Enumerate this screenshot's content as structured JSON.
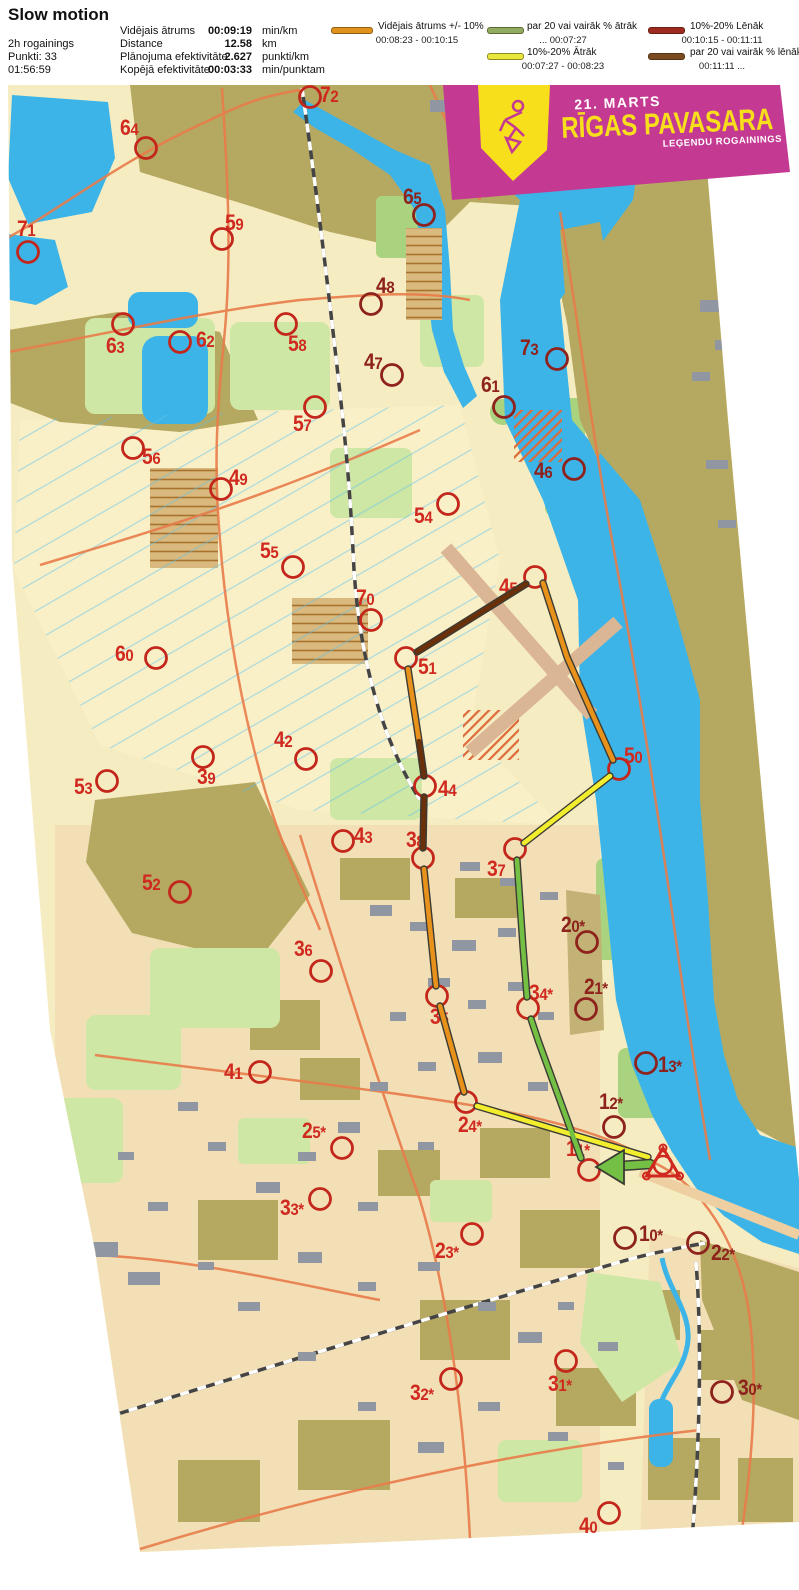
{
  "header": {
    "title": "Slow motion",
    "left": [
      "2h rogainings",
      "Punkti: 33",
      "01:56:59"
    ],
    "stats": [
      {
        "label": "Vidējais ātrums",
        "value": "00:09:19",
        "unit": "min/km"
      },
      {
        "label": "Distance",
        "value": "12.58",
        "unit": "km"
      },
      {
        "label": "Plānojuma efektivitāte",
        "value": "2.627",
        "unit": "punkti/km"
      },
      {
        "label": "Kopējā efektivitāte",
        "value": "00:03:33",
        "unit": "min/punktam"
      }
    ]
  },
  "legend": {
    "items": [
      {
        "name": "average-pace",
        "color": "#e0921f",
        "label": "Vidējais ātrums +/- 10%",
        "range": "00:08:23  -  00:10:15"
      },
      {
        "name": "faster-20",
        "color": "#8fac60",
        "label": "par 20 vai vairāk % ātrāk",
        "range": "...  00:07:27"
      },
      {
        "name": "faster-10-20",
        "color": "#e8e83c",
        "label": "10%-20% Ātrāk",
        "range": "00:07:27  -  00:08:23"
      },
      {
        "name": "slower-10-20",
        "color": "#9e2a20",
        "label": "10%-20% Lēnāk",
        "range": "00:10:15  -  00:11:11"
      },
      {
        "name": "slower-20",
        "color": "#7a4a20",
        "label": "par 20 vai vairāk % lēnāk",
        "range": "00:11:11  ..."
      }
    ]
  },
  "banner": {
    "date": "21. MARTS",
    "title": "RĪGAS PAVASARA",
    "subtitle": "LEĢENDU ROGAININGS",
    "bg": "#c43a93",
    "accent": "#f8df1b"
  },
  "map": {
    "label_color": "#d02a20",
    "label_color_dark": "#8e221c",
    "circle_color": "#c3271b",
    "circle_color_dark": "#8e221c",
    "start": {
      "x": 663,
      "y": 1165
    },
    "controls": [
      {
        "id": "72",
        "x": 310,
        "y": 97,
        "lx": 320,
        "ly": 84
      },
      {
        "id": "64",
        "x": 146,
        "y": 148,
        "lx": 120,
        "ly": 117
      },
      {
        "id": "65",
        "x": 424,
        "y": 215,
        "lx": 403,
        "ly": 186,
        "dark": true
      },
      {
        "id": "71",
        "x": 28,
        "y": 252,
        "lx": 17,
        "ly": 218
      },
      {
        "id": "59",
        "x": 222,
        "y": 239,
        "lx": 225,
        "ly": 212
      },
      {
        "id": "48",
        "x": 371,
        "y": 304,
        "lx": 376,
        "ly": 275,
        "dark": true
      },
      {
        "id": "63",
        "x": 123,
        "y": 324,
        "lx": 106,
        "ly": 335
      },
      {
        "id": "62",
        "x": 180,
        "y": 342,
        "lx": 196,
        "ly": 329
      },
      {
        "id": "58",
        "x": 286,
        "y": 324,
        "lx": 288,
        "ly": 333
      },
      {
        "id": "47",
        "x": 392,
        "y": 375,
        "lx": 364,
        "ly": 351,
        "dark": true
      },
      {
        "id": "57",
        "x": 315,
        "y": 407,
        "lx": 293,
        "ly": 413
      },
      {
        "id": "73",
        "x": 557,
        "y": 359,
        "lx": 520,
        "ly": 337,
        "dark": true
      },
      {
        "id": "61",
        "x": 504,
        "y": 407,
        "lx": 481,
        "ly": 374,
        "dark": true
      },
      {
        "id": "56",
        "x": 133,
        "y": 448,
        "lx": 142,
        "ly": 446
      },
      {
        "id": "49",
        "x": 221,
        "y": 489,
        "lx": 229,
        "ly": 467
      },
      {
        "id": "46",
        "x": 574,
        "y": 469,
        "lx": 534,
        "ly": 460,
        "dark": true
      },
      {
        "id": "54",
        "x": 448,
        "y": 504,
        "lx": 414,
        "ly": 505
      },
      {
        "id": "55",
        "x": 293,
        "y": 567,
        "lx": 260,
        "ly": 540
      },
      {
        "id": "70",
        "x": 371,
        "y": 620,
        "lx": 356,
        "ly": 587
      },
      {
        "id": "45",
        "x": 535,
        "y": 577,
        "lx": 499,
        "ly": 576
      },
      {
        "id": "51",
        "x": 406,
        "y": 658,
        "lx": 418,
        "ly": 656
      },
      {
        "id": "60",
        "x": 156,
        "y": 658,
        "lx": 115,
        "ly": 643
      },
      {
        "id": "50",
        "x": 619,
        "y": 769,
        "lx": 624,
        "ly": 745
      },
      {
        "id": "42",
        "x": 306,
        "y": 759,
        "lx": 274,
        "ly": 729
      },
      {
        "id": "39",
        "x": 203,
        "y": 757,
        "lx": 197,
        "ly": 766
      },
      {
        "id": "44",
        "x": 425,
        "y": 786,
        "lx": 438,
        "ly": 778
      },
      {
        "id": "53",
        "x": 107,
        "y": 781,
        "lx": 74,
        "ly": 776
      },
      {
        "id": "43",
        "x": 343,
        "y": 841,
        "lx": 354,
        "ly": 825
      },
      {
        "id": "38",
        "x": 423,
        "y": 858,
        "lx": 406,
        "ly": 829
      },
      {
        "id": "37",
        "x": 515,
        "y": 849,
        "lx": 487,
        "ly": 858
      },
      {
        "id": "52",
        "x": 180,
        "y": 892,
        "lx": 142,
        "ly": 872
      },
      {
        "id": "20*",
        "x": 587,
        "y": 942,
        "lx": 561,
        "ly": 914,
        "dark": true
      },
      {
        "id": "36",
        "x": 321,
        "y": 971,
        "lx": 294,
        "ly": 938
      },
      {
        "id": "34*",
        "x": 528,
        "y": 1008,
        "lx": 529,
        "ly": 982
      },
      {
        "id": "21*",
        "x": 586,
        "y": 1009,
        "lx": 584,
        "ly": 976,
        "dark": true
      },
      {
        "id": "35",
        "x": 437,
        "y": 996,
        "lx": 430,
        "ly": 1006
      },
      {
        "id": "13*",
        "x": 646,
        "y": 1063,
        "lx": 658,
        "ly": 1054,
        "dark": true
      },
      {
        "id": "41",
        "x": 260,
        "y": 1072,
        "lx": 224,
        "ly": 1061
      },
      {
        "id": "12*",
        "x": 614,
        "y": 1127,
        "lx": 599,
        "ly": 1091,
        "dark": true
      },
      {
        "id": "24*",
        "x": 466,
        "y": 1102,
        "lx": 458,
        "ly": 1114
      },
      {
        "id": "25*",
        "x": 342,
        "y": 1148,
        "lx": 302,
        "ly": 1120
      },
      {
        "id": "11*",
        "x": 589,
        "y": 1170,
        "lx": 566,
        "ly": 1138
      },
      {
        "id": "33*",
        "x": 320,
        "y": 1199,
        "lx": 280,
        "ly": 1197
      },
      {
        "id": "23*",
        "x": 472,
        "y": 1234,
        "lx": 435,
        "ly": 1240
      },
      {
        "id": "10*",
        "x": 625,
        "y": 1238,
        "lx": 639,
        "ly": 1223,
        "dark": true
      },
      {
        "id": "22*",
        "x": 698,
        "y": 1243,
        "lx": 711,
        "ly": 1242,
        "dark": true
      },
      {
        "id": "32*",
        "x": 451,
        "y": 1379,
        "lx": 410,
        "ly": 1382
      },
      {
        "id": "31*",
        "x": 566,
        "y": 1361,
        "lx": 548,
        "ly": 1373
      },
      {
        "id": "30*",
        "x": 722,
        "y": 1392,
        "lx": 738,
        "ly": 1377,
        "dark": true
      },
      {
        "id": "40",
        "x": 609,
        "y": 1513,
        "lx": 579,
        "ly": 1515
      }
    ],
    "route": {
      "colors": {
        "orange": "#e8921b",
        "yellow": "#f2ee2e",
        "green": "#74c044",
        "brown": "#6a3009"
      },
      "segments": [
        {
          "color": "brown",
          "points": [
            [
              417,
              652
            ],
            [
              526,
              584
            ]
          ]
        },
        {
          "color": "orange",
          "points": [
            [
              408,
              669
            ],
            [
              419,
              741
            ]
          ]
        },
        {
          "color": "brown",
          "points": [
            [
              419,
              741
            ],
            [
              424,
              776
            ]
          ]
        },
        {
          "color": "brown",
          "points": [
            [
              424,
              797
            ],
            [
              423,
              848
            ]
          ]
        },
        {
          "color": "orange",
          "points": [
            [
              424,
              869
            ],
            [
              436,
              986
            ]
          ]
        },
        {
          "color": "orange",
          "points": [
            [
              440,
              1006
            ],
            [
              464,
              1092
            ]
          ]
        },
        {
          "color": "yellow",
          "points": [
            [
              477,
              1106
            ],
            [
              648,
              1157
            ]
          ]
        },
        {
          "color": "orange",
          "points": [
            [
              543,
              583
            ],
            [
              567,
              657
            ],
            [
              613,
              760
            ]
          ]
        },
        {
          "color": "yellow",
          "points": [
            [
              610,
              776
            ],
            [
              524,
              843
            ]
          ]
        },
        {
          "color": "green",
          "points": [
            [
              517,
              860
            ],
            [
              523,
              947
            ],
            [
              527,
              997
            ]
          ]
        },
        {
          "color": "green",
          "points": [
            [
              531,
              1019
            ],
            [
              538,
              1040
            ],
            [
              581,
              1158
            ]
          ]
        }
      ],
      "arrow": {
        "color": "green",
        "shaft": [
          [
            650,
            1164
          ],
          [
            620,
            1166
          ]
        ],
        "head": [
          [
            596,
            1167
          ],
          [
            624,
            1150
          ],
          [
            624,
            1184
          ]
        ]
      }
    }
  }
}
